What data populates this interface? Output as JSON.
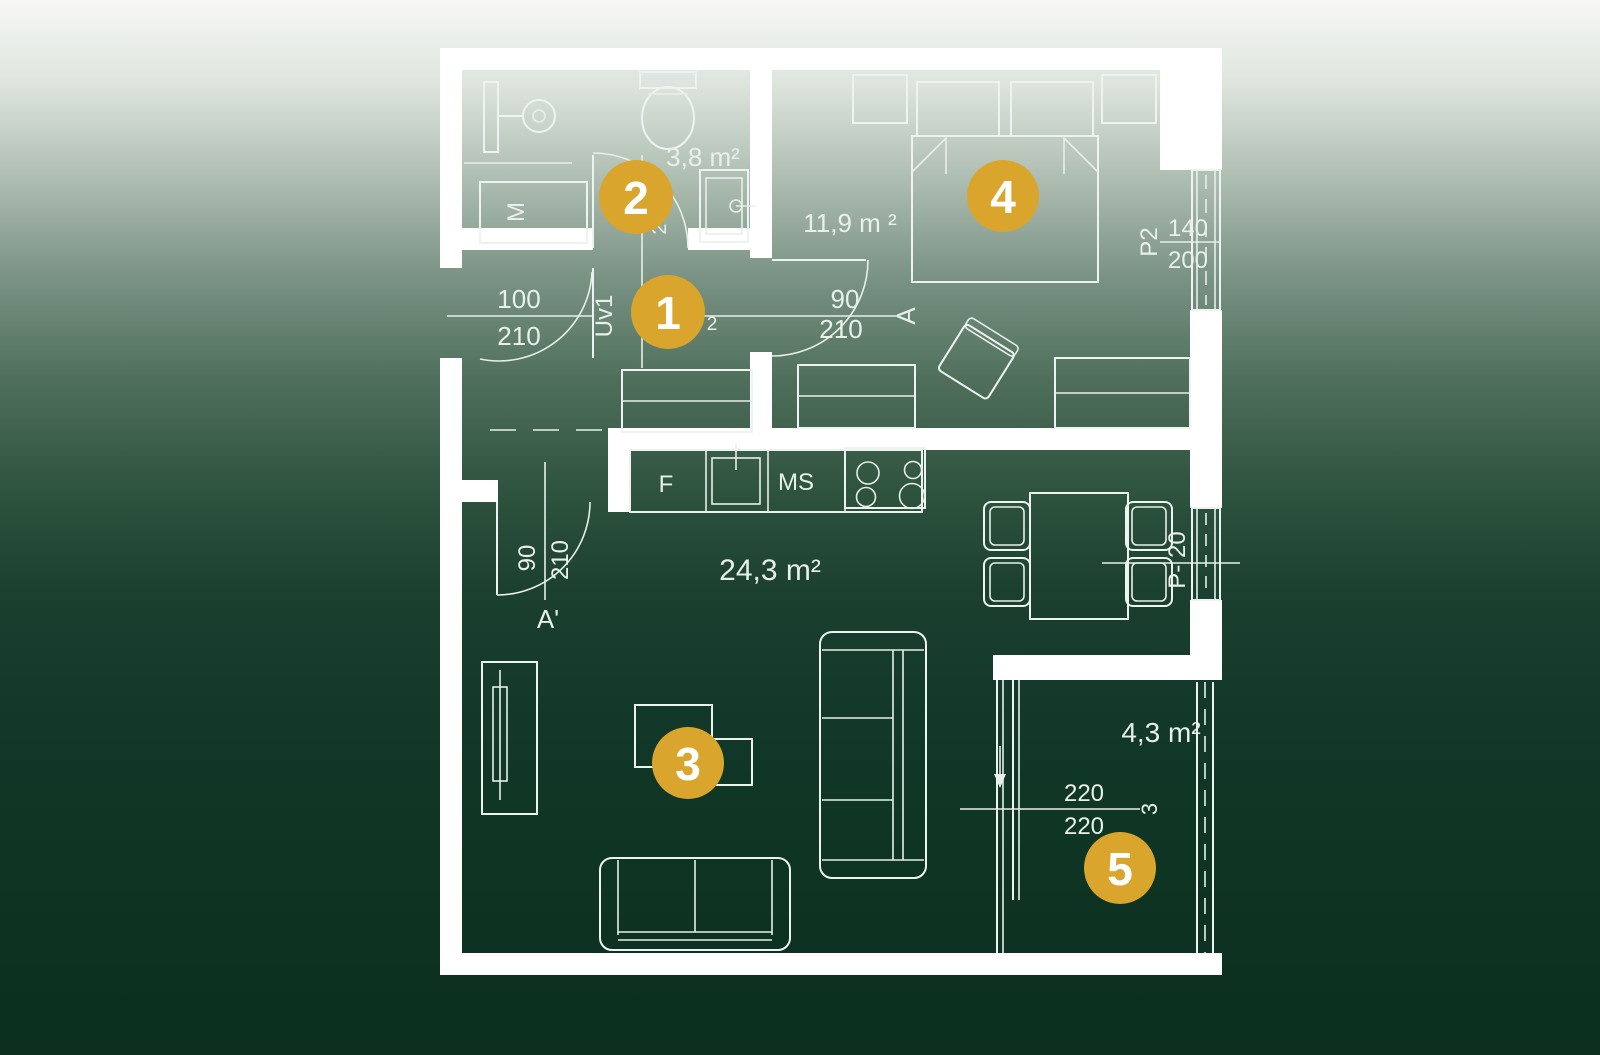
{
  "floorplan": {
    "type": "apartment floor plan",
    "colors": {
      "background_top": "#f6f8f5",
      "background_bottom": "#0c2f1f",
      "line": "#edf3ee",
      "wall": "#ffffff",
      "marker_fill": "#D9A52D",
      "marker_text": "#ffffff"
    },
    "markers": [
      {
        "number": "1"
      },
      {
        "number": "2"
      },
      {
        "number": "3"
      },
      {
        "number": "4"
      },
      {
        "number": "5"
      }
    ],
    "rooms": {
      "hallway": {
        "area_fragment": "2"
      },
      "bathroom": {
        "area": "3,8 m²",
        "washing_machine": "M"
      },
      "living_kitchen": {
        "area": "24,3 m²",
        "fridge": "F",
        "sink": "MS"
      },
      "bedroom": {
        "area": "11,9 m ²"
      },
      "balcony": {
        "area": "4,3 m²"
      }
    },
    "doors": {
      "entrance": {
        "width": "100",
        "height": "210",
        "label": "Uv1"
      },
      "bathroom": {
        "fragment": "2"
      },
      "bedroom": {
        "width": "90",
        "height": "210",
        "section": "A"
      },
      "living": {
        "width": "90",
        "height": "210",
        "section": "A'"
      },
      "balcony": {
        "width": "220",
        "height": "220",
        "ref": "3"
      }
    },
    "windows": {
      "bedroom": {
        "label": "P2",
        "width": "140",
        "height": "200"
      },
      "living": {
        "label": "P- 20"
      }
    }
  }
}
